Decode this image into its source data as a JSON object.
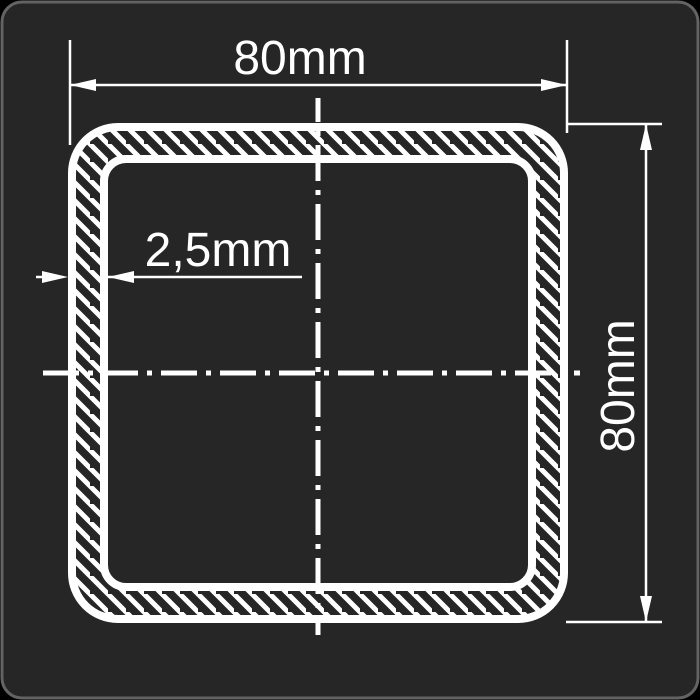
{
  "drawing": {
    "type": "technical-cross-section",
    "subject": "square hollow structural tube profile",
    "labels": {
      "width_dimension": "80mm",
      "height_dimension": "80mm",
      "wall_thickness": "2,5mm"
    },
    "dimensions": {
      "outer_width_mm": 80,
      "outer_height_mm": 80,
      "wall_thickness_mm": 2.5
    },
    "colors": {
      "page_background": "#000000",
      "canvas_background": "#262626",
      "canvas_border": "#636363",
      "line_color": "#ffffff"
    }
  }
}
